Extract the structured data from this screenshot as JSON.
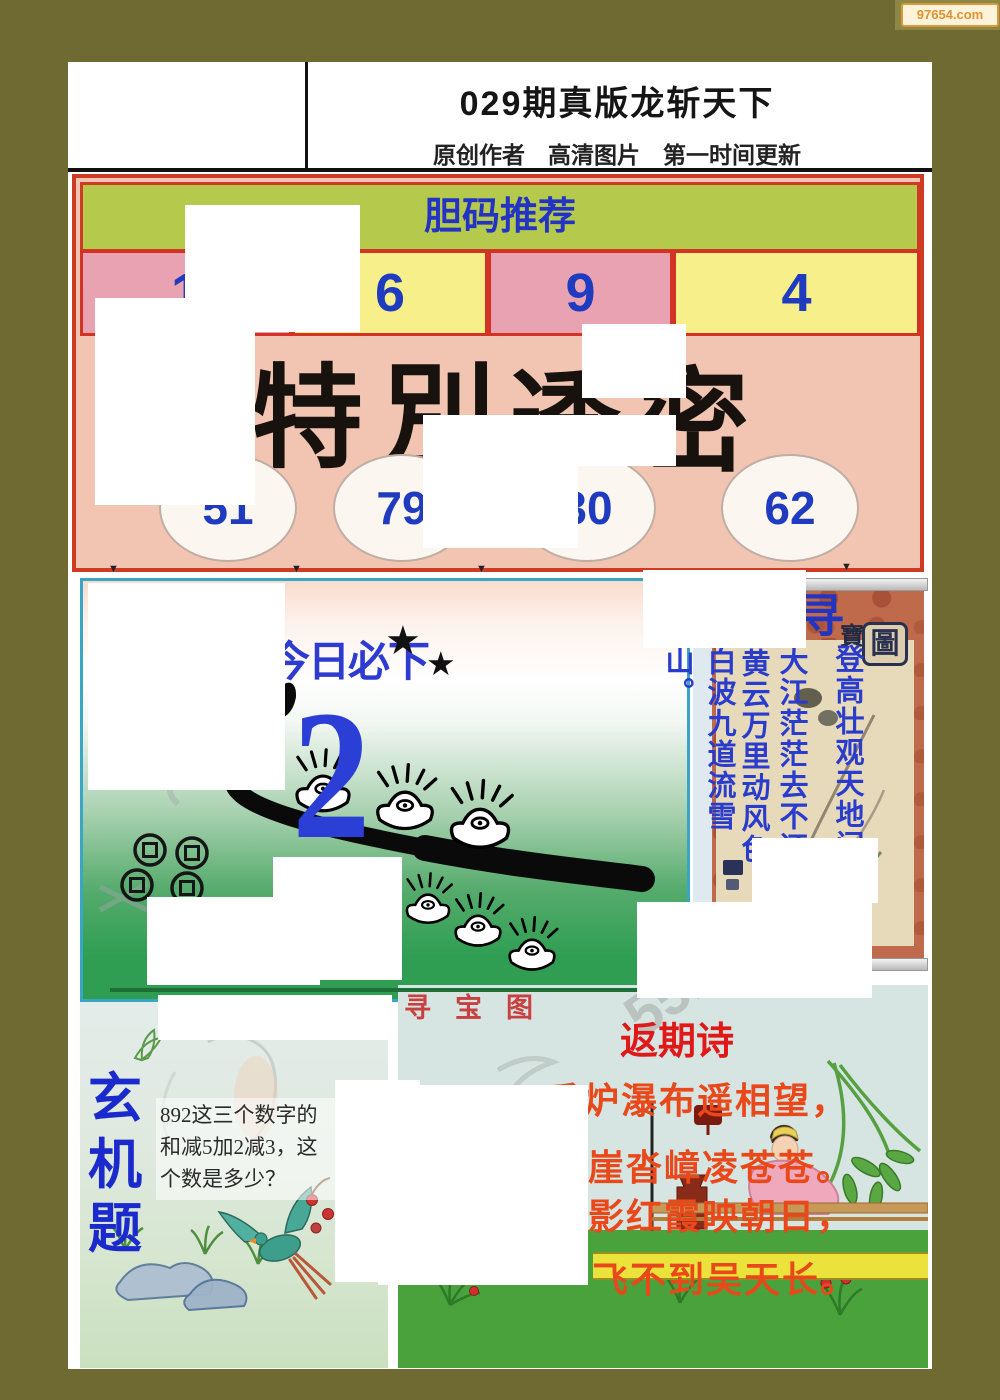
{
  "site": {
    "watermark": "97654.com"
  },
  "header": {
    "title": "029期真版龙斩天下",
    "subtitle": "原创作者　高清图片　第一时间更新"
  },
  "danma": {
    "label": "胆码推荐",
    "n1": "1",
    "n2": "6",
    "n3": "9",
    "n4": "4"
  },
  "special": {
    "c1": "特",
    "c2": "別",
    "c3": "透",
    "c4": "密",
    "o1": "51",
    "o2": "79",
    "o3": "30",
    "o4": "62"
  },
  "daily": {
    "title": "今日必下",
    "big": "2",
    "star": "★"
  },
  "scroll": {
    "t1": "寻",
    "t2": "寶",
    "t3": "圖",
    "col1": "登高壮观天地间",
    "col2": "大江茫茫去不还",
    "col3": "黄云万里动风色",
    "col4": "白波九道流雪山。"
  },
  "mystery": {
    "m1": "玄",
    "m2": "机",
    "m3": "题",
    "q1": "892这三个数字的",
    "q2": "和减5加2减3，这",
    "q3": "个数是多少？"
  },
  "treasure": {
    "label": "寻宝图"
  },
  "poem": {
    "title": "返期诗",
    "l1": "香炉瀑布遥相望，",
    "l2": "崖沓嶂凌苍苍。",
    "l3": "影红霞映朝日，",
    "l4": "飞不到吴天长。"
  },
  "ghost": {
    "digits": "5512"
  },
  "icons": {
    "down_triangle": "▼"
  }
}
